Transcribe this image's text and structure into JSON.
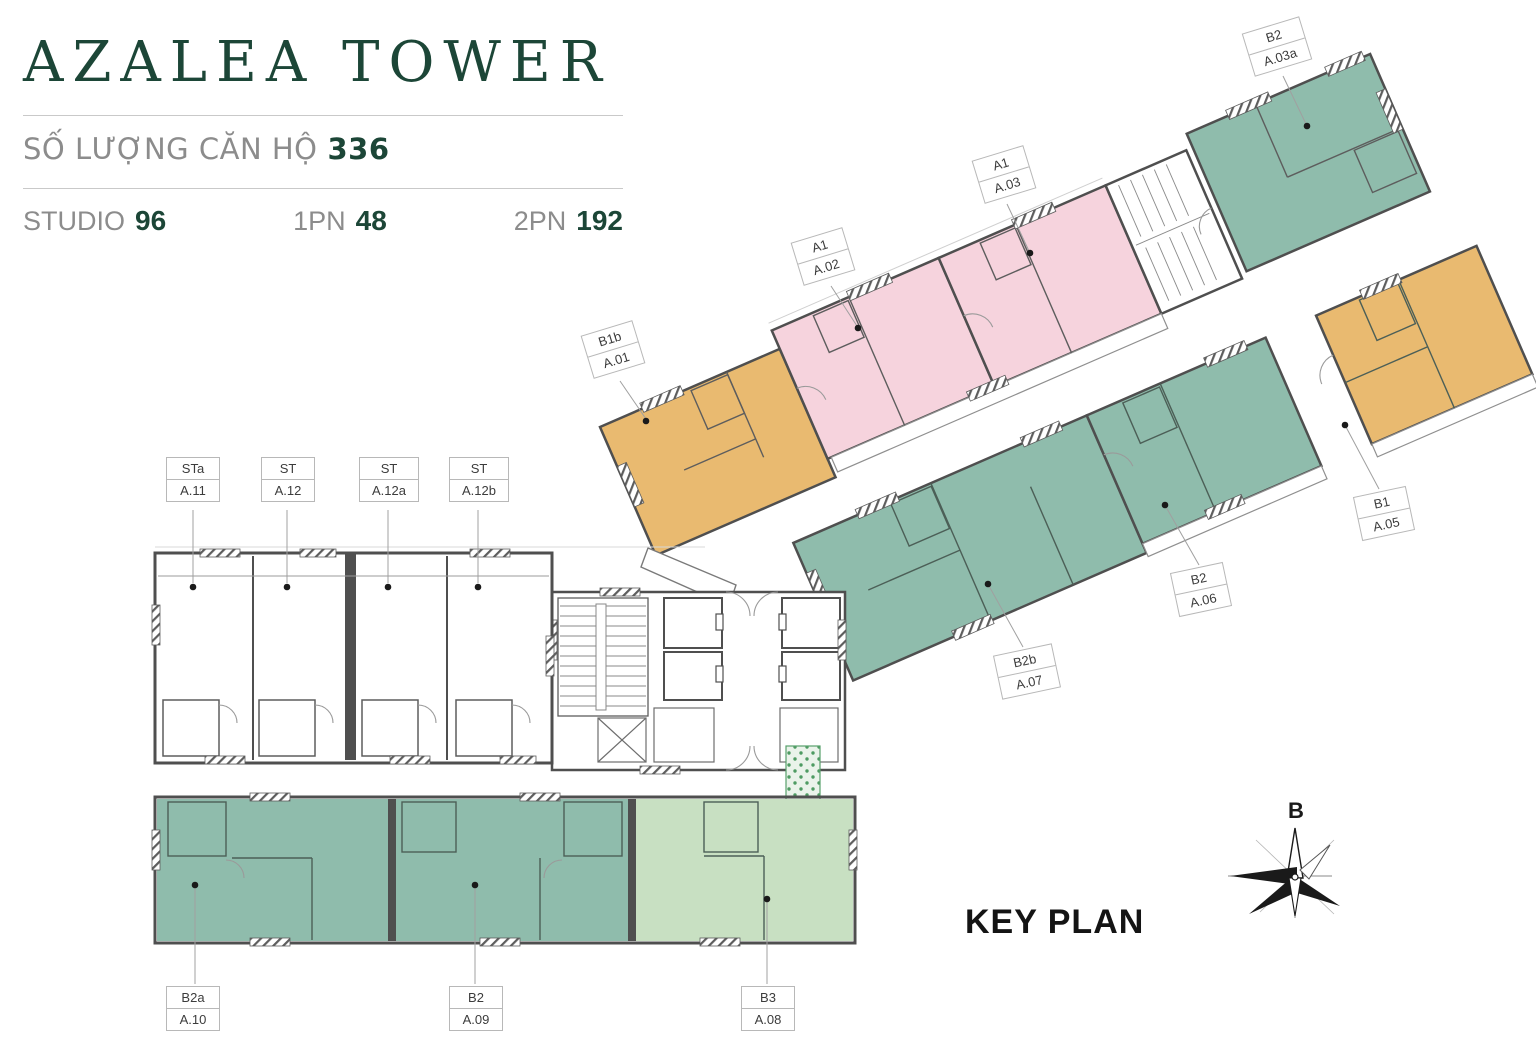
{
  "header": {
    "title": "AZALEA TOWER",
    "units_count_label": "SỐ LƯỢNG CĂN HỘ",
    "units_count_value": "336",
    "stats": [
      {
        "label": "STUDIO",
        "value": "96"
      },
      {
        "label": "1PN",
        "value": "48"
      },
      {
        "label": "2PN",
        "value": "192"
      }
    ]
  },
  "key_plan": {
    "label": "KEY PLAN",
    "compass_north_letter": "B"
  },
  "units": [
    {
      "type": "B1b",
      "number": "A.01",
      "color": "orange"
    },
    {
      "type": "A1",
      "number": "A.02",
      "color": "pink"
    },
    {
      "type": "A1",
      "number": "A.03",
      "color": "pink"
    },
    {
      "type": "B2",
      "number": "A.03a",
      "color": "teal"
    },
    {
      "type": "B1",
      "number": "A.05",
      "color": "orange"
    },
    {
      "type": "B2",
      "number": "A.06",
      "color": "teal"
    },
    {
      "type": "B2b",
      "number": "A.07",
      "color": "teal"
    },
    {
      "type": "B3",
      "number": "A.08",
      "color": "light_green"
    },
    {
      "type": "B2",
      "number": "A.09",
      "color": "teal"
    },
    {
      "type": "B2a",
      "number": "A.10",
      "color": "teal"
    },
    {
      "type": "STa",
      "number": "A.11",
      "color": "white"
    },
    {
      "type": "ST",
      "number": "A.12",
      "color": "white"
    },
    {
      "type": "ST",
      "number": "A.12a",
      "color": "white"
    },
    {
      "type": "ST",
      "number": "A.12b",
      "color": "white"
    }
  ],
  "colors": {
    "accent_green": "#1c4637",
    "muted_text": "#8c8c8c",
    "teal": "#8fbcac",
    "pink": "#f6d3dd",
    "orange": "#e9ba70",
    "light_green": "#c8e0c2",
    "wall": "#4f4f4f"
  }
}
